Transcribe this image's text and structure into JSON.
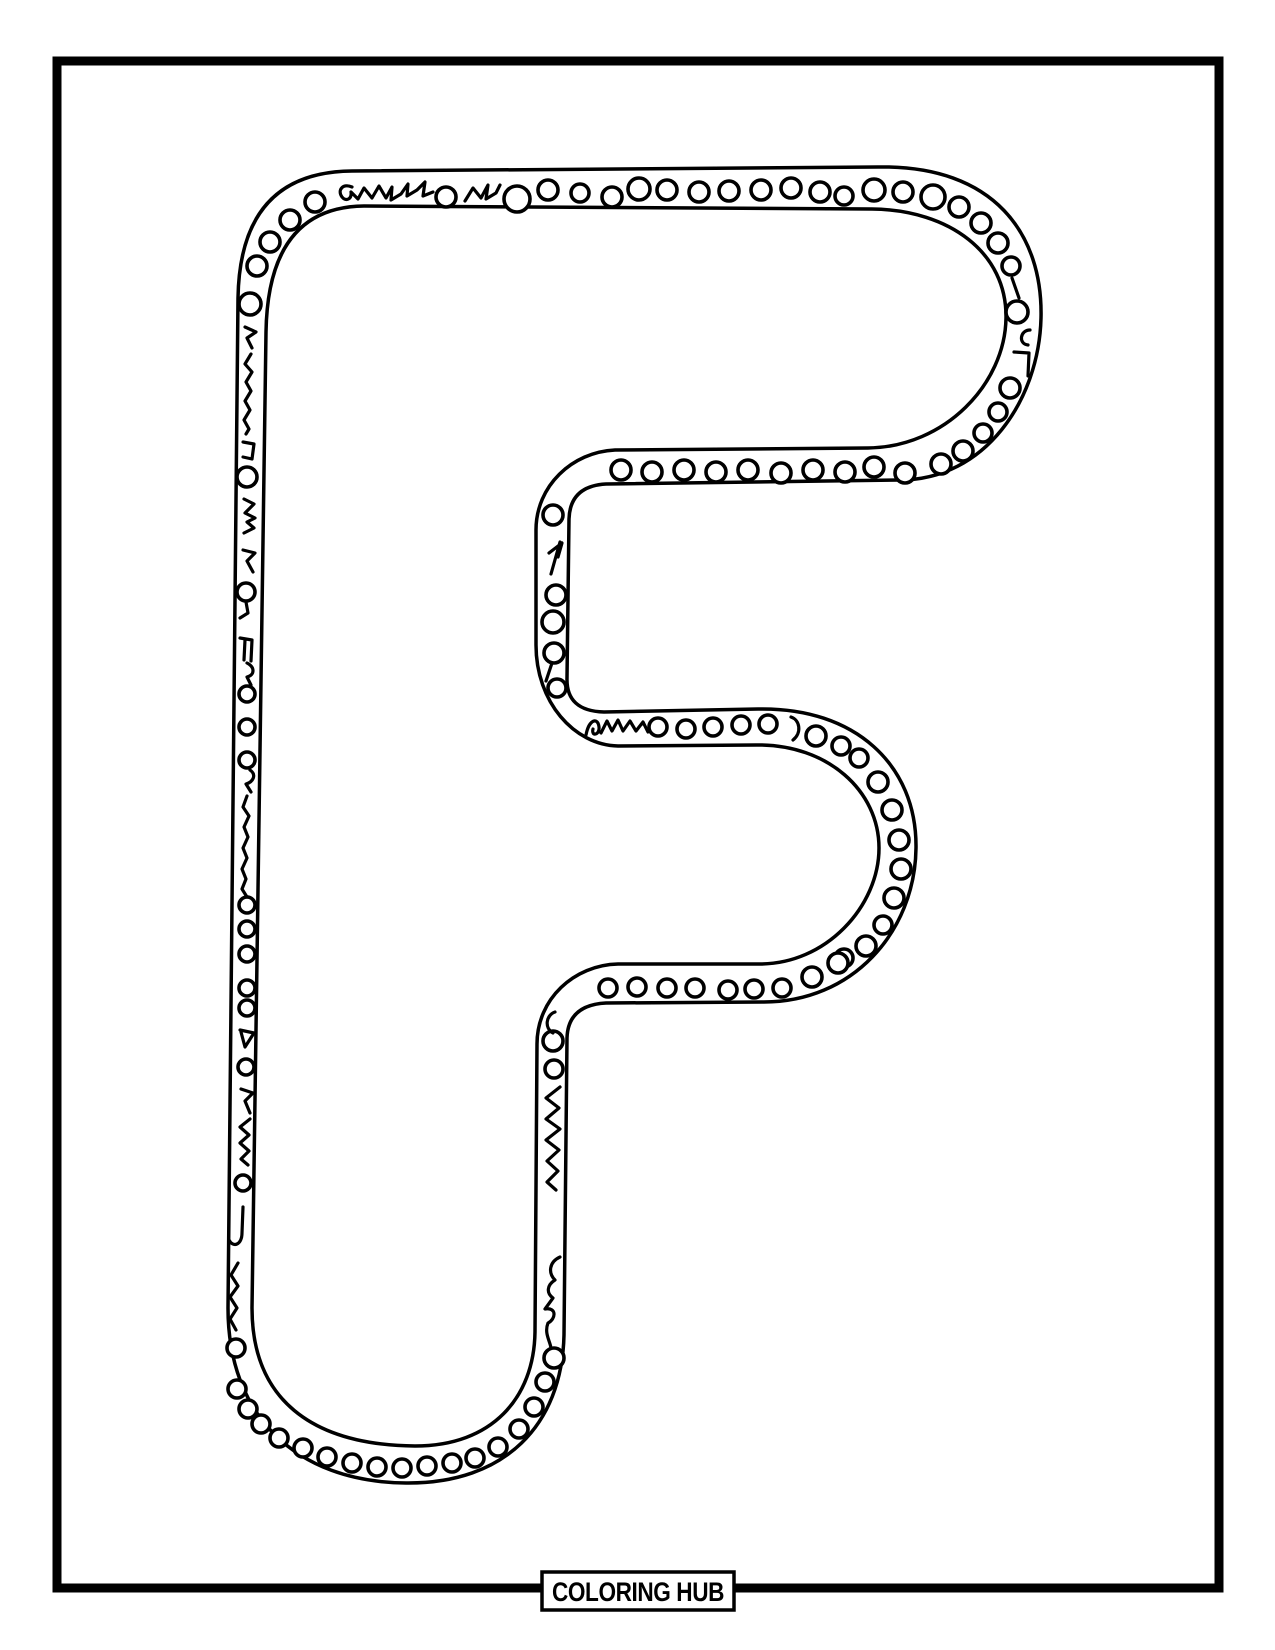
{
  "page": {
    "kind": "coloring-page",
    "letter": "F",
    "colors": {
      "ink": "#000000",
      "paper": "#ffffff"
    }
  },
  "footer": {
    "label": "COLORING HUB"
  }
}
